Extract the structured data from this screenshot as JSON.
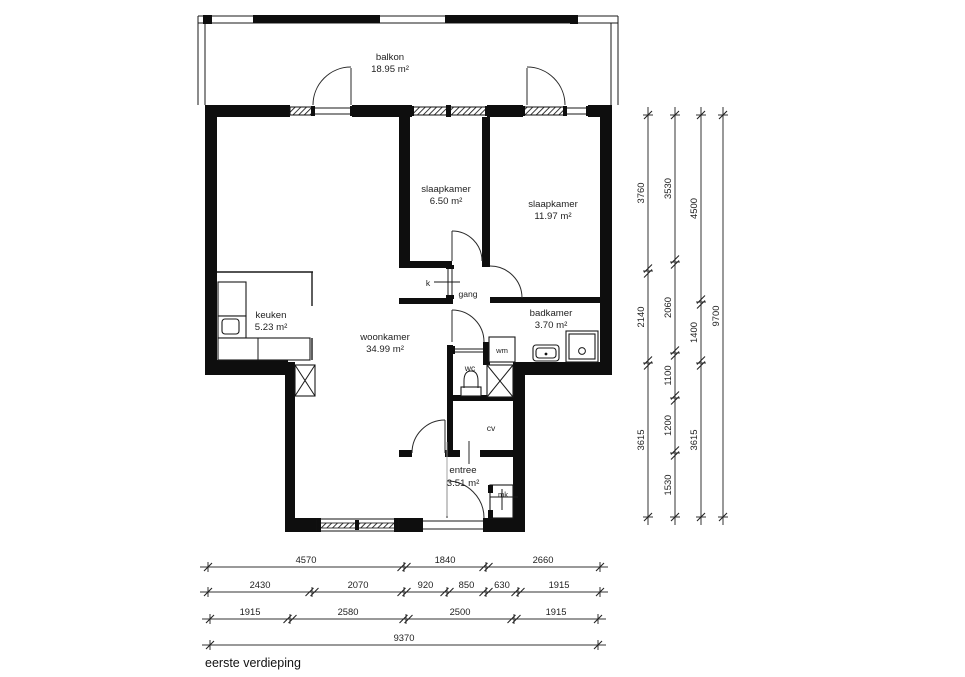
{
  "floor": {
    "title": "eerste verdieping"
  },
  "rooms": {
    "balkon": {
      "name": "balkon",
      "area": "18.95 m²"
    },
    "slaapkamer1": {
      "name": "slaapkamer",
      "area": "6.50 m²"
    },
    "slaapkamer2": {
      "name": "slaapkamer",
      "area": "11.97 m²"
    },
    "keuken": {
      "name": "keuken",
      "area": "5.23 m²"
    },
    "woonkamer": {
      "name": "woonkamer",
      "area": "34.99 m²"
    },
    "badkamer": {
      "name": "badkamer",
      "area": "3.70 m²"
    },
    "entree": {
      "name": "entree",
      "area": "3.51 m²"
    },
    "gang": {
      "name": "gang"
    },
    "wc": {
      "name": "wc"
    },
    "kast": {
      "name": "k"
    },
    "wasmachine": {
      "name": "wm"
    },
    "cv": {
      "name": "cv"
    },
    "meterkast": {
      "name": "mk"
    }
  },
  "colors": {
    "wall": "#0e0e0e",
    "line": "#1a1a1a",
    "text": "#1f1f1f",
    "background": "#ffffff"
  },
  "dimensions": {
    "right_lines": [
      {
        "x": 648,
        "ticks": [
          115,
          271,
          363,
          517
        ],
        "labels": [
          "3760",
          "2140",
          "3615"
        ]
      },
      {
        "x": 675,
        "ticks": [
          115,
          262,
          353,
          398,
          453,
          517
        ],
        "labels": [
          "3530",
          "2060",
          "1100",
          "1200",
          "1530"
        ]
      },
      {
        "x": 701,
        "ticks": [
          115,
          302,
          363,
          517
        ],
        "labels": [
          "4500",
          "1400",
          "3615"
        ]
      },
      {
        "x": 723,
        "ticks": [
          115,
          517
        ],
        "labels": [
          "9700"
        ]
      }
    ],
    "bottom_lines": [
      {
        "y": 567,
        "ticks": [
          208,
          404,
          486,
          600
        ],
        "labels": [
          "4570",
          "1840",
          "2660"
        ]
      },
      {
        "y": 592,
        "ticks": [
          208,
          312,
          404,
          447,
          486,
          518,
          600
        ],
        "labels": [
          "2430",
          "2070",
          "920",
          "850",
          "630",
          "1915"
        ]
      },
      {
        "y": 619,
        "ticks": [
          210,
          290,
          406,
          514,
          598
        ],
        "labels": [
          "1915",
          "2580",
          "2500",
          "1915"
        ]
      },
      {
        "y": 645,
        "ticks": [
          210,
          598
        ],
        "labels": [
          "9370"
        ]
      }
    ]
  }
}
